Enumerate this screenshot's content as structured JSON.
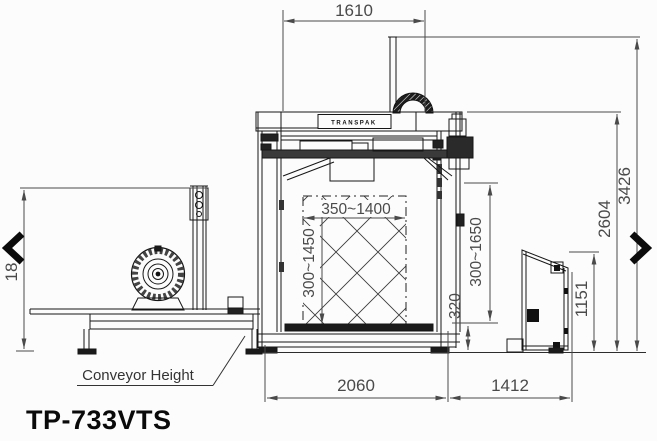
{
  "page": {
    "model_label": "TP-733VTS"
  },
  "drawing": {
    "brand": "TRANSPAK",
    "conveyor_label": "Conveyor Height",
    "dims": {
      "top_width": "1610",
      "total_height": "3426",
      "body_height": "2604",
      "cabinet_height": "1151",
      "left_height_partial": "18",
      "pack_width": "350~1400",
      "pack_height_inner": "300~1450",
      "pack_height_outer": "300~1650",
      "table_height": "320",
      "base_width": "2060",
      "right_width": "1412"
    },
    "colors": {
      "line": "#161616",
      "dimension": "#4a4a4a",
      "background": "#fcfcfc"
    }
  },
  "carousel": {
    "prev_icon": "chevron-left",
    "next_icon": "chevron-right"
  }
}
